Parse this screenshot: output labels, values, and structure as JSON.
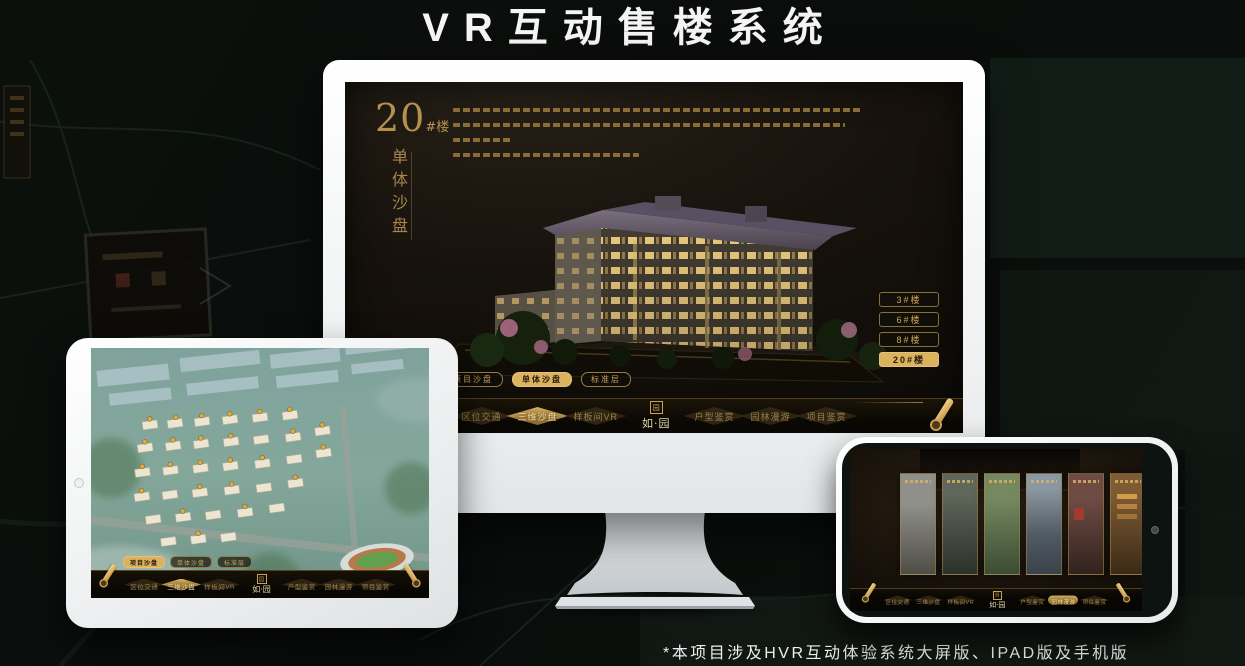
{
  "page": {
    "title": "VR互动售楼系统",
    "footnote": "*本项目涉及HVR互动体验系统大屏版、IPAD版及手机版"
  },
  "colors": {
    "accent_gold": "#c9a35d",
    "accent_gold_bright": "#ddb25f",
    "screen_background": "#16110b",
    "device_white": "#f4f5f6"
  },
  "logo": {
    "text": "如·园",
    "seal": "园"
  },
  "monitor": {
    "headline_number": "20",
    "headline_unit": "#楼",
    "headline_subtitle": "单体沙盘",
    "floor_buttons": [
      {
        "label": "3#楼",
        "active": false
      },
      {
        "label": "6#楼",
        "active": false
      },
      {
        "label": "8#楼",
        "active": false
      },
      {
        "label": "20#楼",
        "active": true
      }
    ],
    "view_tabs": [
      {
        "label": "项目沙盘",
        "active": false
      },
      {
        "label": "单体沙盘",
        "active": true
      },
      {
        "label": "标准层",
        "active": false
      }
    ],
    "nav_left": [
      {
        "label": "区位交通",
        "active": false
      },
      {
        "label": "三维沙盘",
        "active": true
      },
      {
        "label": "样板间VR",
        "active": false
      }
    ],
    "nav_right": [
      {
        "label": "户型鉴赏",
        "active": false
      },
      {
        "label": "园林漫游",
        "active": false
      },
      {
        "label": "项目鉴赏",
        "active": false
      }
    ]
  },
  "tablet": {
    "view_tabs": [
      {
        "label": "项目沙盘",
        "active": true
      },
      {
        "label": "单体沙盘",
        "active": false
      },
      {
        "label": "标准层",
        "active": false
      }
    ],
    "nav_left": [
      {
        "label": "区位交通",
        "active": false
      },
      {
        "label": "三维沙盘",
        "active": true
      },
      {
        "label": "样板间VR",
        "active": false
      }
    ],
    "nav_right": [
      {
        "label": "户型鉴赏",
        "active": false
      },
      {
        "label": "园林漫游",
        "active": false
      },
      {
        "label": "项目鉴赏",
        "active": false
      }
    ]
  },
  "phone": {
    "nav_left": [
      {
        "label": "区位交通",
        "active": false
      },
      {
        "label": "三维沙盘",
        "active": false
      },
      {
        "label": "样板间VR",
        "active": false
      }
    ],
    "nav_right": [
      {
        "label": "户型鉴赏",
        "active": false
      },
      {
        "label": "园林漫游",
        "active": true
      },
      {
        "label": "项目鉴赏",
        "active": false
      }
    ]
  }
}
